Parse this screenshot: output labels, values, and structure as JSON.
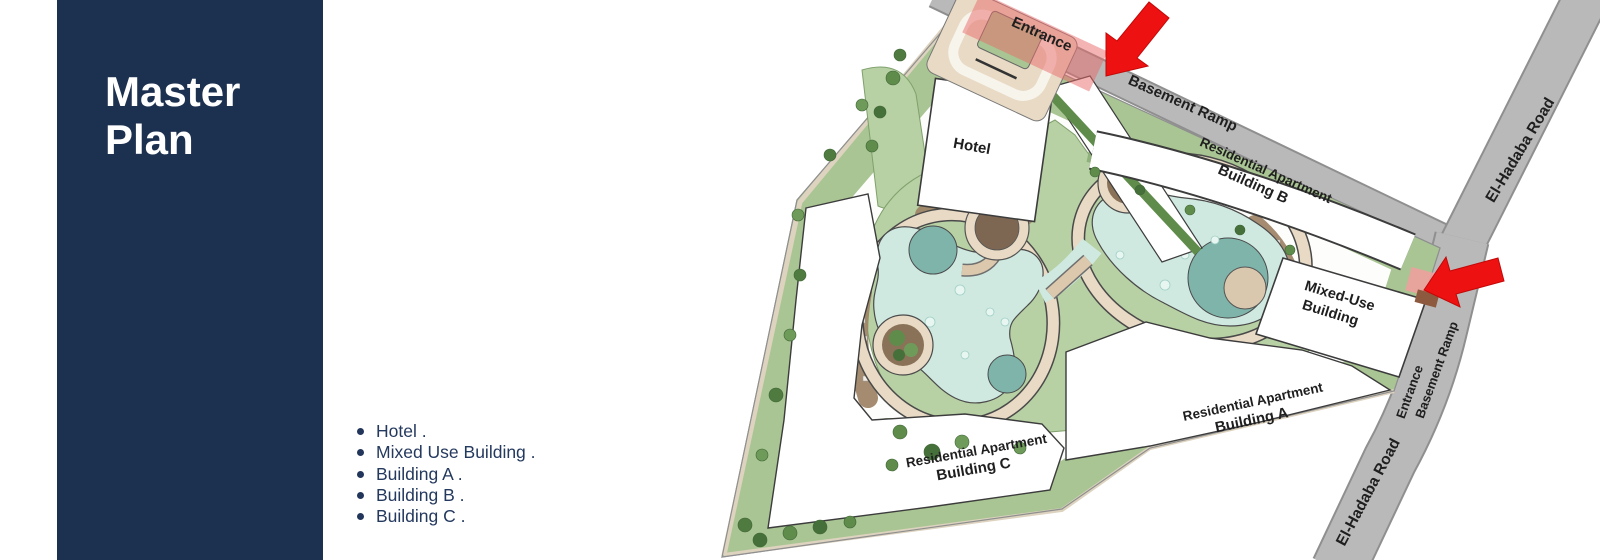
{
  "sidebar": {
    "title_line1": "Master",
    "title_line2": "Plan"
  },
  "legend": {
    "items": [
      "Hotel .",
      "Mixed Use Building .",
      "Building A .",
      "Building B .",
      "Building C ."
    ]
  },
  "map": {
    "labels": {
      "entrance_top": "Entrance",
      "basement_ramp_top": "Basement Ramp",
      "el_hadaba_road_top": "El-Hadaba Road",
      "el_hadaba_road_bottom": "El-Hadaba Road",
      "hotel": "Hotel",
      "residential_apartment": "Residential Apartment",
      "building_a": "Building A",
      "building_b": "Building B",
      "building_c": "Building C",
      "mixed_use_line1": "Mixed-Use",
      "mixed_use_line2": "Building",
      "entrance_side": "Entrance",
      "basement_ramp_side": "Basement Ramp"
    },
    "colors": {
      "sidebar_navy": "#1c3050",
      "road_gray": "#b9b9b9",
      "green": "#b7d0a4",
      "green_dark": "#5f8c4b",
      "pool": "#cfe9e1",
      "pool_deep": "#7fb4ab",
      "path_tan": "#e8dac4",
      "deck_brown": "#a08669",
      "arrow_red": "#ee1111",
      "entrance_highlight": "#e96a6a"
    }
  }
}
